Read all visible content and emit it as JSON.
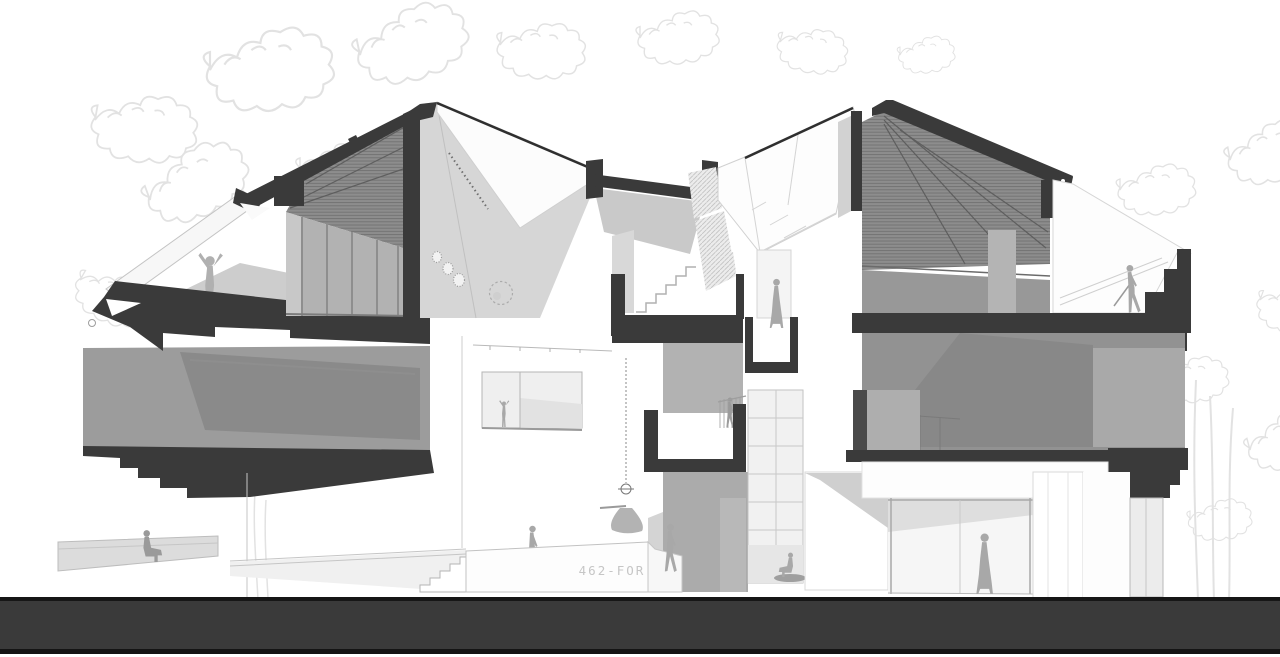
{
  "scene": {
    "sign_text": "462-FOR"
  },
  "figures": [
    "person-arms-raised",
    "person-walking",
    "person-standing-dress",
    "person-seated",
    "person-climbing-stairs"
  ],
  "colors": {
    "background": "#ffffff",
    "ink_line": "#2f2f2f",
    "section_cut": "#3a3a3a",
    "ground_band": "#3a3a3a",
    "ground_edge": "#161616",
    "roof_hatch_bg": "#8d8d8d",
    "roof_hatch_line": "#717171",
    "rafter_line": "#5e5e5e",
    "wall_mid": "#989898",
    "wall_inner": "#8a8a8a",
    "wall_soft": "#b2b2b2",
    "wall_light": "#d6d6d6",
    "ceiling_gray": "#c9c9c9",
    "glass_light": "#f1f1f1",
    "figure_silhouette": "#a8a8a8",
    "tree_line": "#e2e2e2",
    "outline": "#c4c4c4",
    "sign_text_color": "#c6c6c6"
  }
}
